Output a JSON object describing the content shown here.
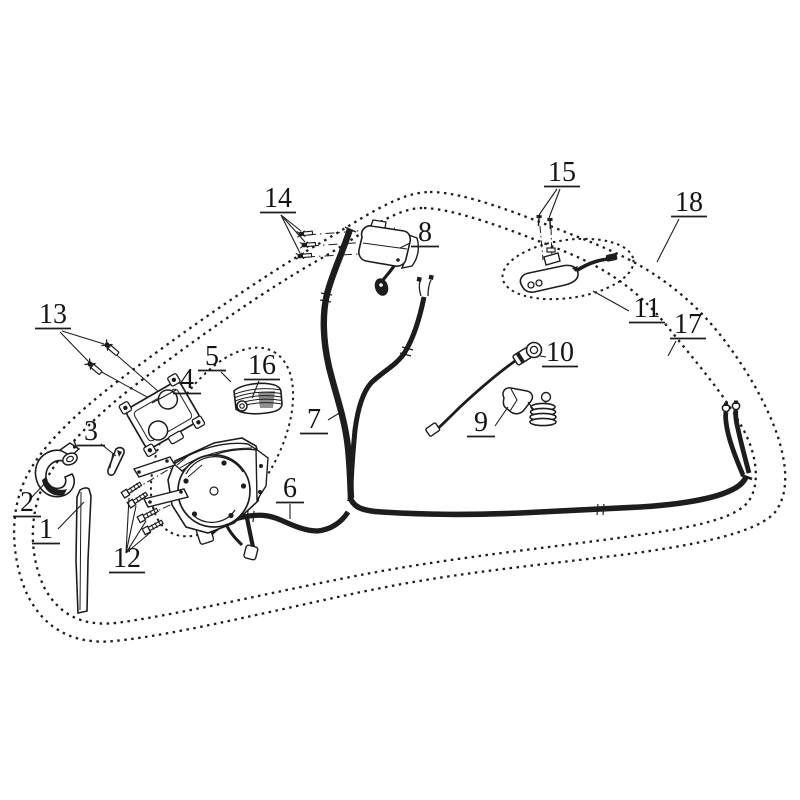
{
  "diagram": {
    "type": "exploded-parts-line-drawing",
    "background_color": "#ffffff",
    "line_color": "#1d1d1d",
    "shade_color": "#8f8f8f",
    "callout_count": 18,
    "grouping_outlines": [
      "outer-dotted-boundary-18",
      "inner-dotted-boundary-17",
      "dotted-ellipse-5",
      "dotted-ellipse-11"
    ]
  },
  "callouts": [
    {
      "number": "1"
    },
    {
      "number": "2"
    },
    {
      "number": "3"
    },
    {
      "number": "4"
    },
    {
      "number": "5"
    },
    {
      "number": "6"
    },
    {
      "number": "7"
    },
    {
      "number": "8"
    },
    {
      "number": "9"
    },
    {
      "number": "10"
    },
    {
      "number": "11"
    },
    {
      "number": "12"
    },
    {
      "number": "13"
    },
    {
      "number": "14"
    },
    {
      "number": "15"
    },
    {
      "number": "16"
    },
    {
      "number": "17"
    },
    {
      "number": "18"
    }
  ]
}
